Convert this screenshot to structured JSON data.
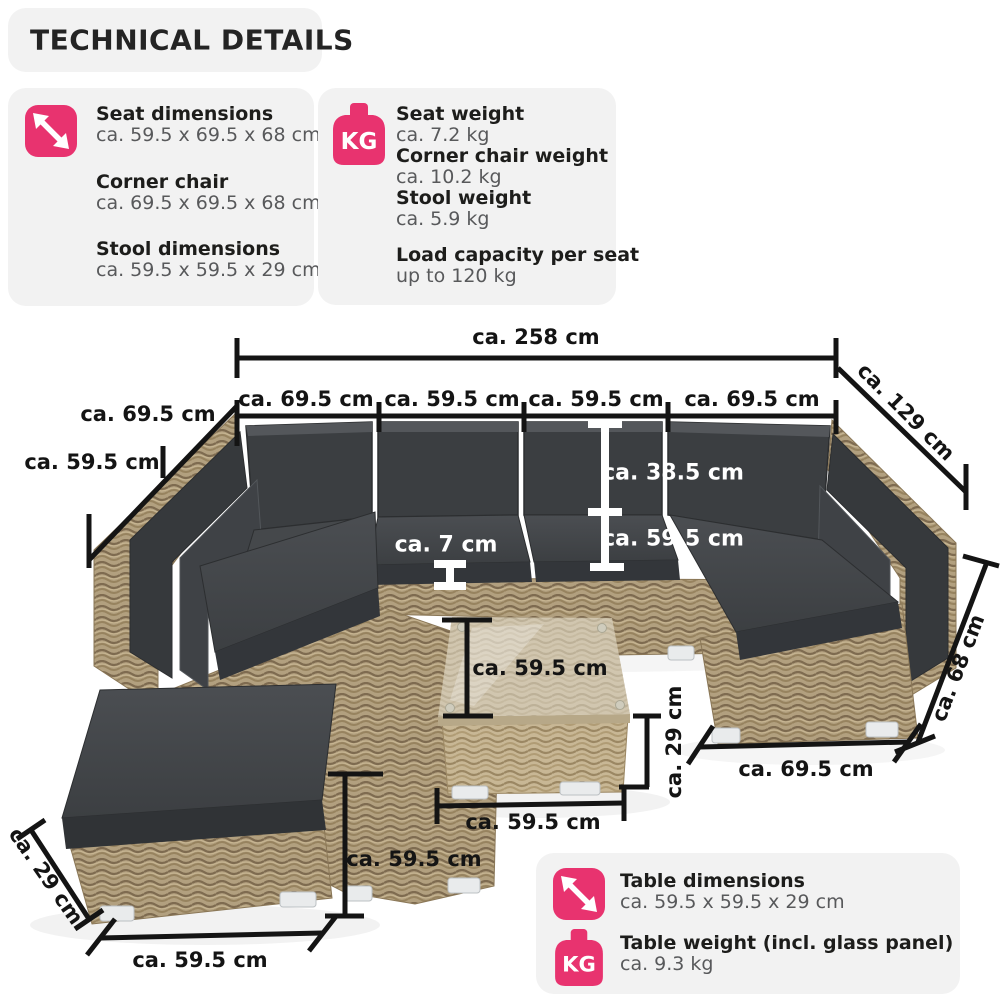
{
  "title": "TECHNICAL DETAILS",
  "colors": {
    "accent_pink": "#e8336f",
    "panel_bg": "#f2f2f2",
    "heading_text": "#1d1d1b",
    "value_text": "#58595b",
    "dimension_line": "#141414",
    "white_dimension": "#ffffff"
  },
  "icons": {
    "kg_label": "KG"
  },
  "panels": {
    "dimensions": {
      "icon": "diagonal-arrows-icon",
      "items": [
        {
          "label": "Seat dimensions",
          "value": "ca. 59.5 x 69.5 x 68 cm"
        },
        {
          "label": "Corner chair",
          "value": "ca. 69.5 x 69.5 x 68 cm"
        },
        {
          "label": "Stool dimensions",
          "value": "ca. 59.5 x 59.5 x 29 cm"
        }
      ]
    },
    "weights": {
      "icon": "kg-weight-icon",
      "items": [
        {
          "label": "Seat weight",
          "value": "ca. 7.2 kg"
        },
        {
          "label": "Corner chair weight",
          "value": "ca. 10.2 kg"
        },
        {
          "label": "Stool weight",
          "value": "ca. 5.9 kg"
        },
        {
          "label": "Load capacity per seat",
          "value": "up to 120 kg"
        }
      ]
    },
    "table": {
      "items": [
        {
          "icon": "diagonal-arrows-icon",
          "label": "Table dimensions",
          "value": "ca. 59.5 x 59.5 x 29 cm"
        },
        {
          "icon": "kg-weight-icon",
          "label": "Table weight (incl. glass panel)",
          "value": "ca. 9.3 kg"
        }
      ]
    }
  },
  "annotations": {
    "overall_width": "ca. 258 cm",
    "seat_width_1": "ca. 69.5 cm",
    "seat_width_2": "ca. 59.5 cm",
    "seat_width_3": "ca. 59.5 cm",
    "seat_width_4": "ca. 69.5 cm",
    "diagonal_depth": "ca. 129 cm",
    "left_depth": "ca. 69.5 cm",
    "left_seat_depth": "ca. 59.5 cm",
    "backrest_height": "ca. 38.5 cm",
    "seat_depth": "ca. 59.5 cm",
    "cushion_height": "ca. 7 cm",
    "side_height": "ca. 68 cm",
    "right_seat_width": "ca. 69.5 cm",
    "table_depth": "ca. 59.5 cm",
    "table_height": "ca. 29 cm",
    "table_width": "ca. 59.5 cm",
    "stool_depth": "ca. 59.5 cm",
    "stool_height": "ca. 29 cm",
    "stool_width": "ca. 59.5 cm"
  }
}
